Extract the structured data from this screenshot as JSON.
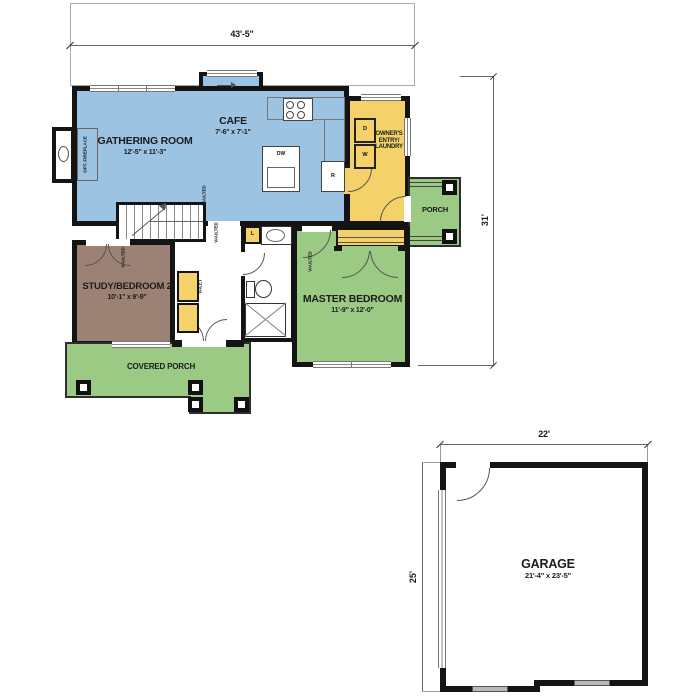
{
  "dimensions": {
    "overall_width": "43'-5\"",
    "overall_depth": "31'",
    "garage_width": "22'",
    "garage_depth": "25'"
  },
  "rooms": {
    "gathering_room": {
      "name": "GATHERING ROOM",
      "size": "12'-5\" x 11'-3\""
    },
    "cafe": {
      "name": "CAFE",
      "size": "7'-6\" x 7'-1\""
    },
    "owners_entry": {
      "name": "OWNER'S ENTRY/ LAUNDRY"
    },
    "porch": {
      "name": "PORCH"
    },
    "study_bedroom2": {
      "name": "STUDY/BEDROOM 2",
      "size": "10'-1\" x 9'-9\""
    },
    "master_bedroom": {
      "name": "MASTER BEDROOM",
      "size": "11'-9\" x 12'-0\""
    },
    "covered_porch": {
      "name": "COVERED PORCH"
    },
    "garage": {
      "name": "GARAGE",
      "size": "21'-4\" x 23'-5\""
    }
  },
  "annotations": {
    "opt_fireplace": "OPT. FIREPLACE",
    "vaulted": "VAULTED",
    "valet": "VALET"
  },
  "fixtures": {
    "dryer": "D",
    "washer": "W",
    "refrigerator": "R",
    "dishwasher": "DW",
    "linen": "L"
  },
  "colors": {
    "living_blue": "#9cc3e2",
    "storage_yellow": "#f4d269",
    "outdoor_green": "#9bca85",
    "study_brown": "#9b8275",
    "wall_black": "#141414"
  }
}
